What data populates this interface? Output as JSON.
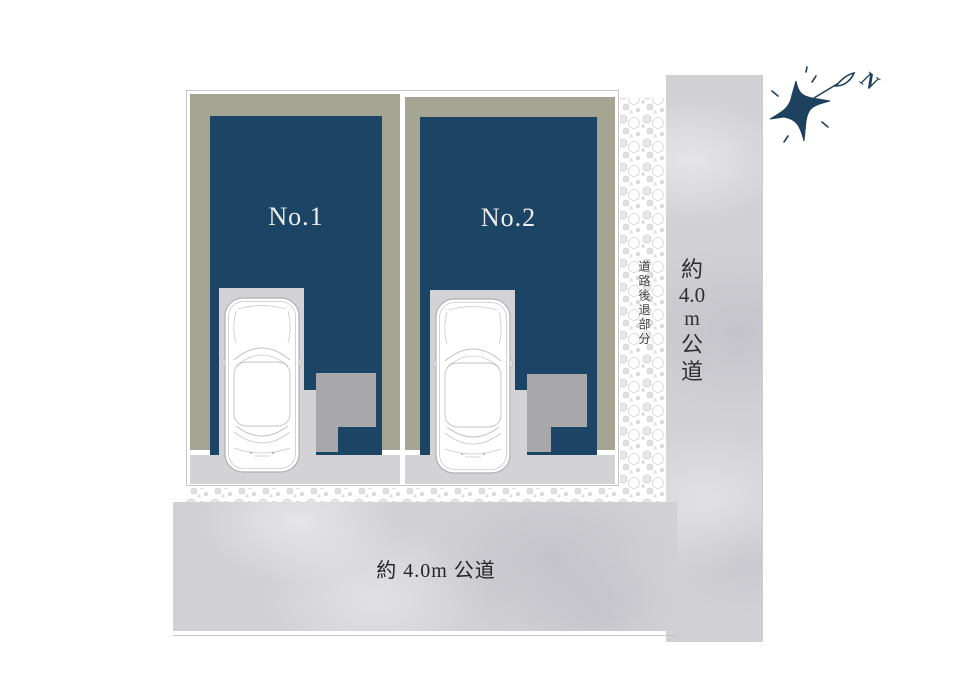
{
  "colors": {
    "building_navy": "#1c4565",
    "lot_olive": "#a6a593",
    "paving_light_gray": "#d3d3d7",
    "porch_gray": "#a8a8ab",
    "road_gray": "#d1d0d5",
    "label_white": "#edeee9",
    "text_dark": "#2e2e2e",
    "compass_navy": "#1d415e"
  },
  "lots": [
    {
      "label": "No.1"
    },
    {
      "label": "No.2"
    }
  ],
  "roads": {
    "right": {
      "chars": [
        "約",
        "4.0",
        "m",
        "公",
        "道"
      ]
    },
    "bottom": {
      "label": "約 4.0m 公道"
    }
  },
  "setback": {
    "label": "道路後退部分"
  },
  "compass": {
    "north_label": "N"
  }
}
